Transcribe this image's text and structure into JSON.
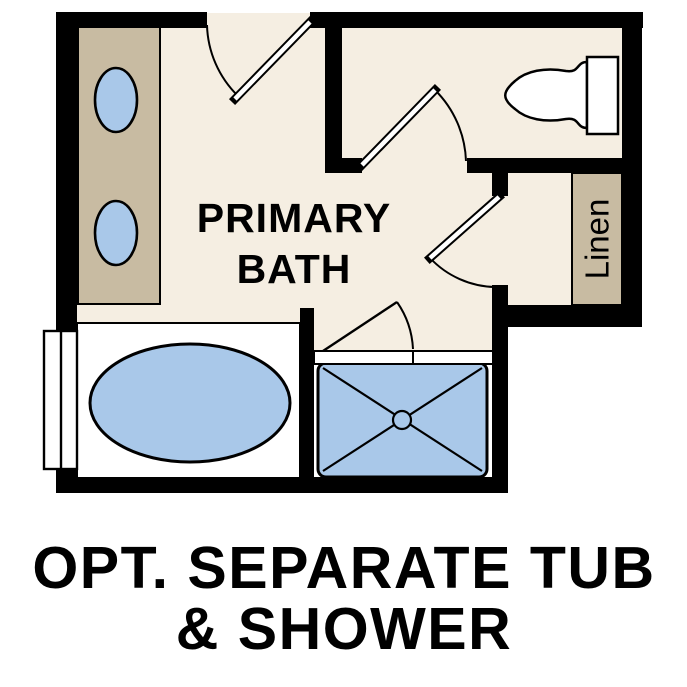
{
  "labels": {
    "room_line1": "PRIMARY",
    "room_line2": "BATH",
    "linen": "Linen",
    "caption_line1": "OPT. SEPARATE TUB",
    "caption_line2": "& SHOWER"
  },
  "colors": {
    "wall": "#000000",
    "floor": "#f5eee2",
    "cabinet_tan": "#c8bba2",
    "fixture_blue": "#a9c8e9",
    "fixture_white": "#ffffff",
    "text": "#000000"
  }
}
